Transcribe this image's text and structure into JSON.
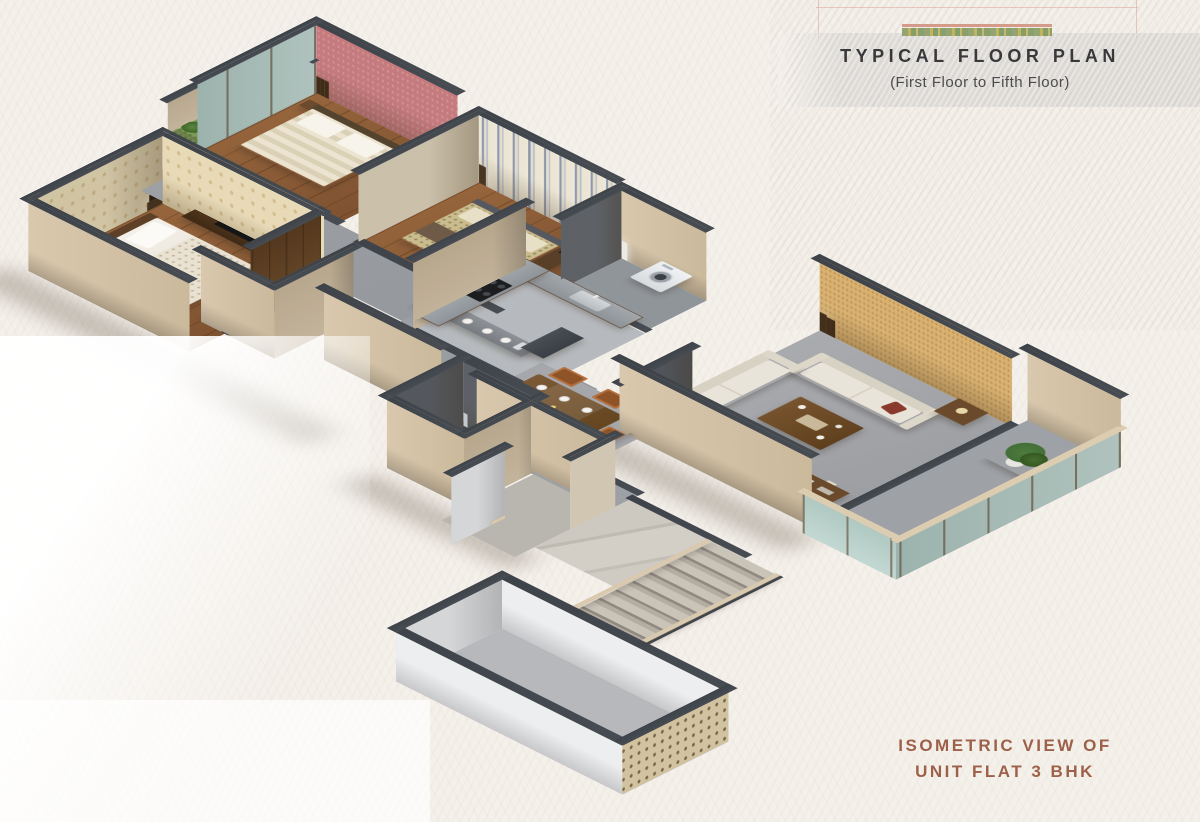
{
  "header": {
    "title": "TYPICAL FLOOR PLAN",
    "subtitle": "(First Floor to Fifth Floor)"
  },
  "caption": {
    "line1": "ISOMETRIC VIEW OF",
    "line2": "UNIT FLAT 3 BHK",
    "text_color": "#9d6049"
  },
  "decor": {
    "strip_line_color": "#d49a8a",
    "strip_band_colors": [
      "#93a471",
      "#c2b35e",
      "#c9b869"
    ],
    "band_color": "#cbc9c7"
  },
  "scene": {
    "type": "isometric-floor-plan",
    "view": "isometric",
    "unit_type": "3 BHK",
    "rooms": [
      "master-bedroom",
      "attached-bathroom",
      "bedroom-2",
      "bedroom-2-balcony",
      "bedroom-3",
      "utility-bathroom",
      "kitchen",
      "dining-area",
      "foyer-passage",
      "living-room",
      "living-balcony",
      "lift",
      "entrance-lobby",
      "staircase",
      "stair-void"
    ],
    "palette": {
      "paper": "#f4f0ea",
      "wall_cap": "#474c53",
      "wall_exterior_beige": "#d9c8ad",
      "wall_white": "#edeef0",
      "floor_gray": "#a9abaf",
      "corridor_gray": "#9da0a5",
      "kitchen_tile": "#b6b9bd",
      "floor_wood": "#96653c",
      "lift_wood": "#8d6b4a",
      "marble": "#cdc9c1",
      "wall_damask_cream": "#e8dab6",
      "wall_pink": "#c57a7e",
      "wall_stripe_blue": "#8d98ae",
      "wall_gold": "#d9b273",
      "balcony_grass": "#7d9a58",
      "glass": "#bdd3cc",
      "sofa_cream": "#e9e4d9",
      "furniture_wood": "#6f4f2d",
      "chair_orange": "#b5703e",
      "plant_green": "#3f6a35",
      "dark_wall": "#5d6167"
    }
  }
}
